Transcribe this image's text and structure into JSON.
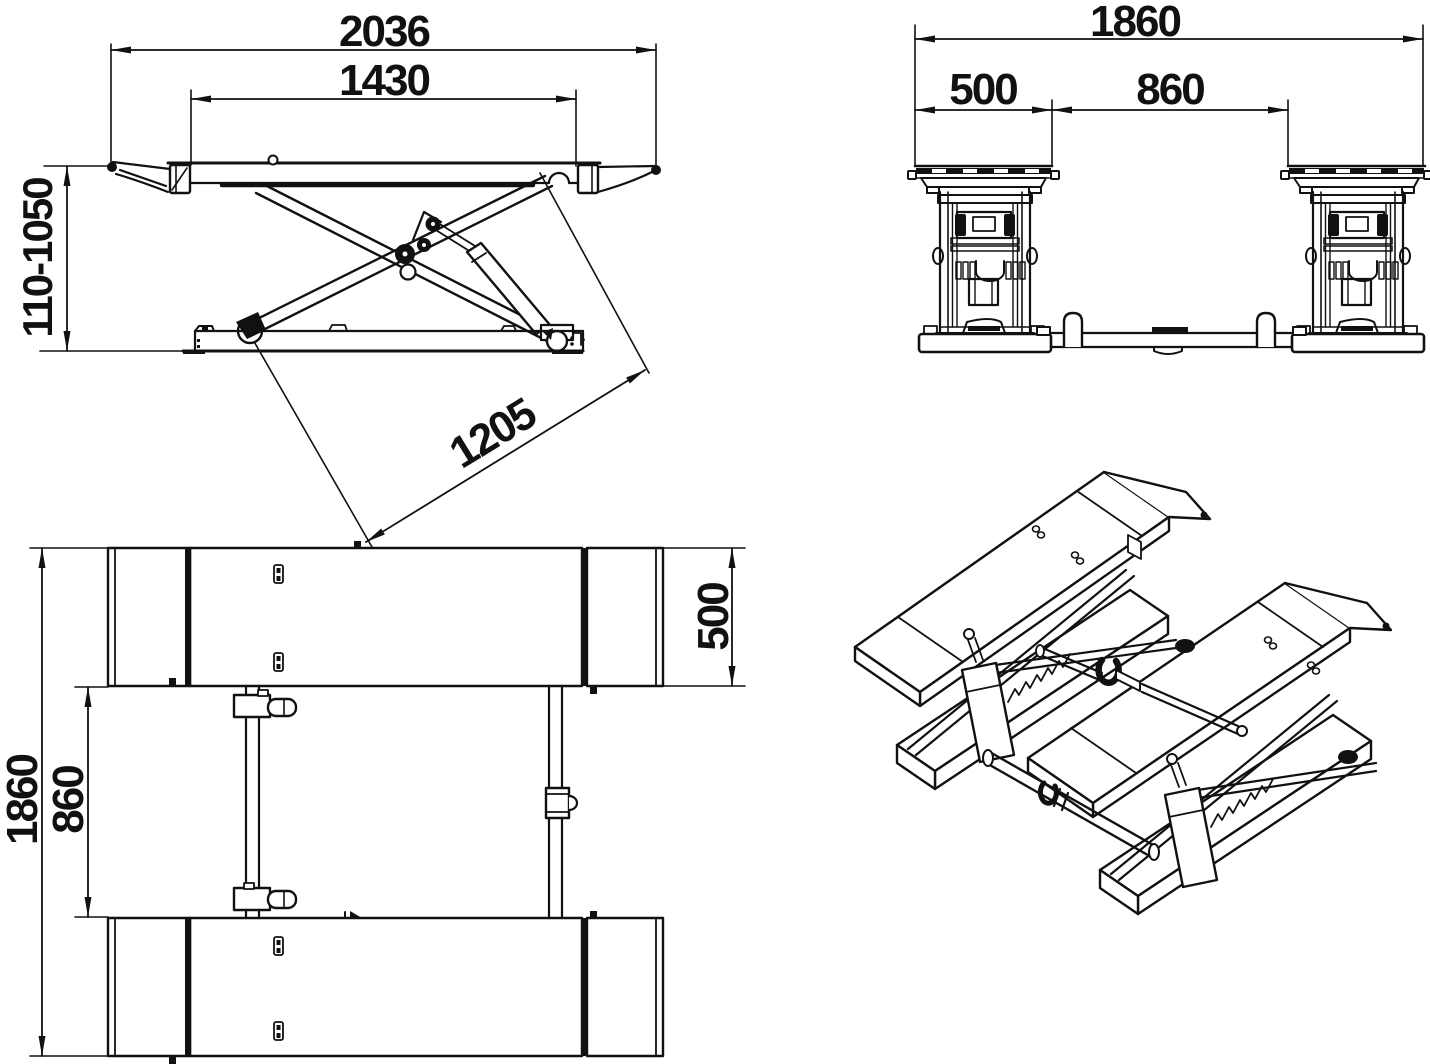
{
  "drawing": {
    "title": "scissor-lift-dimension-drawing",
    "units": "mm",
    "line_color": "#111111",
    "background_color": "#ffffff",
    "dims": {
      "side": {
        "overall_length": "2036",
        "runway_length": "1430",
        "lifting_height_range": "110-1050",
        "arm_span": "1205"
      },
      "front": {
        "overall_width": "1860",
        "runway_width": "500",
        "between_runways": "860"
      },
      "plan": {
        "overall_width": "1860",
        "between_runways": "860",
        "runway_width": "500"
      }
    }
  }
}
